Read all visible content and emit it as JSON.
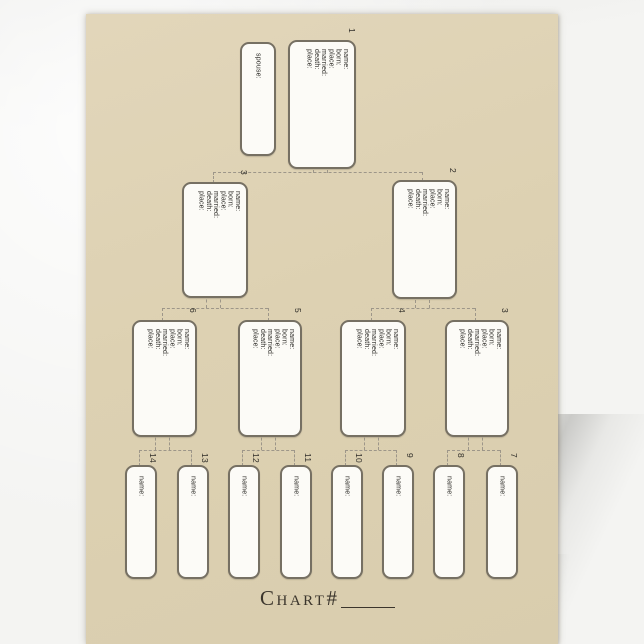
{
  "document": {
    "type_label": "pedigree chart letterhead",
    "footer": {
      "chart_label": "Chart#",
      "chart_number_value": ""
    },
    "colors": {
      "paper": "#ddd1b2",
      "box_border": "#767063",
      "connector": "#9d9689",
      "ink": "#2b2a26"
    }
  },
  "field_sets": {
    "full": [
      "name:",
      "born:",
      "place:",
      "married:",
      "death:",
      "place:"
    ],
    "name_only": [
      "name:"
    ],
    "spouse": [
      "spouse:"
    ]
  },
  "boxes": [
    {
      "id": "spouse",
      "number": "",
      "fields": "spouse"
    },
    {
      "id": "b1",
      "number": "1",
      "fields": "full"
    },
    {
      "id": "b3",
      "number": "3",
      "fields": "full"
    },
    {
      "id": "b2",
      "number": "2",
      "fields": "full"
    },
    {
      "id": "b6",
      "number": "6",
      "fields": "full"
    },
    {
      "id": "b5",
      "number": "5",
      "fields": "full"
    },
    {
      "id": "b4",
      "number": "4",
      "fields": "full"
    },
    {
      "id": "b3r",
      "number": "3",
      "fields": "full"
    },
    {
      "id": "s14",
      "number": "14",
      "fields": "name_only"
    },
    {
      "id": "s13",
      "number": "13",
      "fields": "name_only"
    },
    {
      "id": "s12",
      "number": "12",
      "fields": "name_only"
    },
    {
      "id": "s11",
      "number": "11",
      "fields": "name_only"
    },
    {
      "id": "s10",
      "number": "10",
      "fields": "name_only"
    },
    {
      "id": "s9",
      "number": "9",
      "fields": "name_only"
    },
    {
      "id": "s8",
      "number": "8",
      "fields": "name_only"
    },
    {
      "id": "s7",
      "number": "7",
      "fields": "name_only"
    }
  ]
}
